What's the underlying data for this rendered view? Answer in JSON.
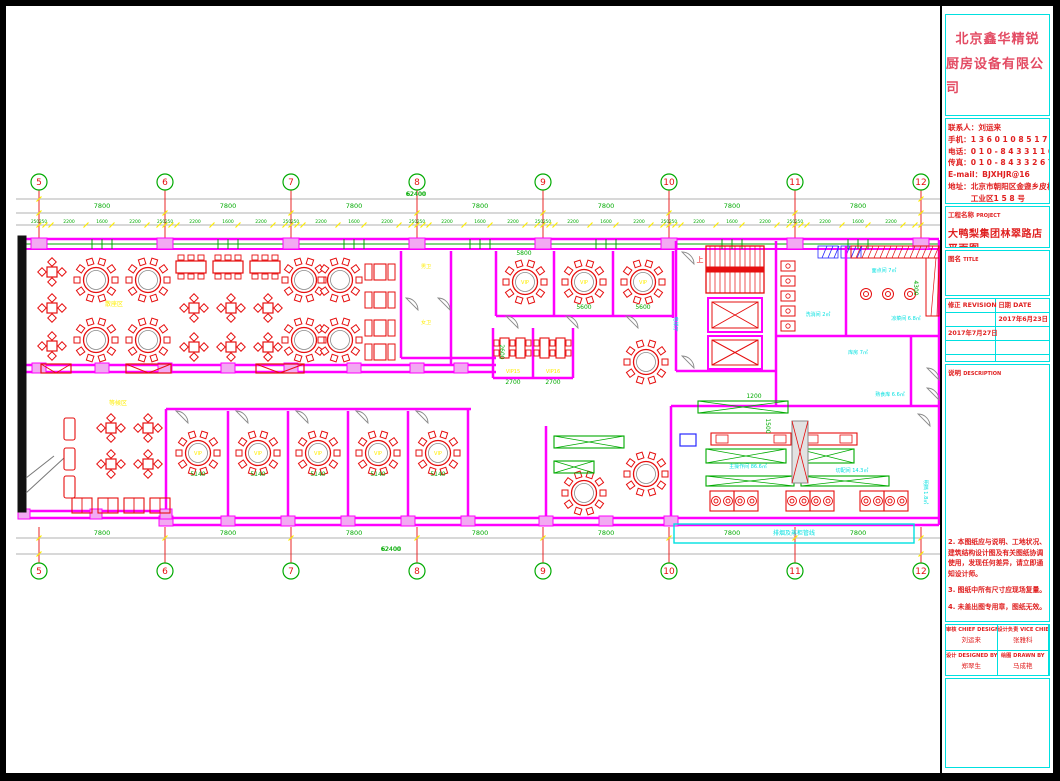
{
  "titleblock": {
    "company_line1": "北京鑫华精锐",
    "company_line2": "厨房设备有限公司",
    "contact": {
      "lines": [
        "联系人：刘运来",
        "手机：1 3 6 0 1 0 8 5 1 7 1",
        "电话：0 1 0 - 8 4 3 3 1 1 6 5",
        "传真：0 1 0 - 8 4 3 3 2 6 7 9",
        "E-mail：BJXHJR@16",
        "地址：北京市朝阳区金盏乡皮村",
        "　　　工业区1 5 8 号"
      ]
    },
    "project_label": "工程名称",
    "project_label_en": "PROJECT",
    "project_name": "大鸭梨集团林翠路店平面图",
    "title_label": "图名",
    "title_label_en": "TITLE",
    "revision_label": "修正",
    "revision_label_en": "REVISION",
    "date_label": "日期",
    "date_label_en": "DATE",
    "revisions": [
      {
        "rev": "",
        "date": "2017年6月23日"
      },
      {
        "rev": "2017年7月27日",
        "date": ""
      },
      {
        "rev": "",
        "date": ""
      },
      {
        "rev": "",
        "date": ""
      }
    ],
    "desc_label": "说明",
    "desc_label_en": "DESCRIPTION",
    "notes": [
      "2. 本图纸应与说明、工地状况、建筑结构设计图及有关图纸协调使用，发现任何差异，请立即通知设计师。",
      "3. 图纸中所有尺寸应现场复量。",
      "4. 未盖出图专用章，图纸无效。"
    ],
    "sign": {
      "chief_label": "审核",
      "chief_en": "CHIEF DESIGNER",
      "chief_name": "刘运来",
      "vice_label": "设计负责",
      "vice_en": "VICE CHIEF DESIGNER",
      "vice_name": "张雅科",
      "designed_label": "设计",
      "designed_en": "DESIGNED BY",
      "designed_name": "郑翠生",
      "drawn_label": "绘图",
      "drawn_en": "DRAWN BY",
      "drawn_name": "马成艳"
    }
  },
  "plan": {
    "colors": {
      "m": "#ff00ff",
      "r": "#e60f0f",
      "g": "#00c800",
      "y": "#ffee00",
      "c": "#00e0e0",
      "k": "#000000",
      "e": "#8a8a8a",
      "b": "#2828ff",
      "p": "#f2a9f2",
      "d": "#00aa00"
    },
    "grid": {
      "labels": [
        "5",
        "6",
        "7",
        "8",
        "9",
        "10",
        "11",
        "12"
      ],
      "xs": [
        33,
        159,
        285,
        411,
        537,
        663,
        789,
        915
      ],
      "top_bubble_y": 176,
      "bottom_bubble_y": 565,
      "bay_label": "7800",
      "total_label": "62400",
      "chain_center_label": "250250",
      "chain_labels": [
        "2200",
        "1600",
        "2200"
      ],
      "chain_offsets": [
        30,
        63,
        96
      ],
      "tick_offsets": [
        6,
        12,
        47,
        73,
        108,
        120
      ]
    },
    "gray_hlines": [
      [
        10,
        193,
        936
      ],
      [
        10,
        207,
        936
      ],
      [
        10,
        219,
        936
      ],
      [
        10,
        532,
        936
      ],
      [
        10,
        548,
        936
      ]
    ],
    "walls_h": [
      [
        18,
        359,
        490
      ],
      [
        18,
        366,
        490
      ],
      [
        490,
        310,
        667
      ],
      [
        487,
        372,
        567
      ],
      [
        670,
        365,
        770
      ],
      [
        770,
        330,
        933
      ],
      [
        665,
        400,
        933
      ],
      [
        160,
        403,
        465
      ],
      [
        395,
        352,
        490
      ],
      [
        18,
        505,
        160
      ],
      [
        18,
        512,
        160
      ],
      [
        160,
        512,
        665
      ],
      [
        160,
        519,
        665
      ],
      [
        665,
        512,
        933
      ],
      [
        665,
        519,
        933
      ]
    ],
    "walls_v": [
      [
        445,
        245,
        359
      ],
      [
        490,
        245,
        310
      ],
      [
        548,
        245,
        310
      ],
      [
        607,
        245,
        310
      ],
      [
        667,
        245,
        312
      ],
      [
        487,
        322,
        372
      ],
      [
        527,
        322,
        372
      ],
      [
        567,
        322,
        372
      ],
      [
        670,
        235,
        365
      ],
      [
        770,
        235,
        400
      ],
      [
        840,
        240,
        330
      ],
      [
        905,
        330,
        400
      ],
      [
        933,
        234,
        519
      ],
      [
        18,
        234,
        505
      ],
      [
        160,
        403,
        512
      ],
      [
        222,
        405,
        512
      ],
      [
        282,
        405,
        512
      ],
      [
        342,
        405,
        512
      ],
      [
        402,
        405,
        512
      ],
      [
        462,
        403,
        519
      ],
      [
        540,
        420,
        512
      ],
      [
        665,
        400,
        519
      ],
      [
        395,
        245,
        352
      ]
    ],
    "top_wall": {
      "y1": 233,
      "y2": 243,
      "mid": 238,
      "x1": 18,
      "x2": 933
    },
    "posts_south": [
      33,
      96,
      159,
      222,
      285,
      348,
      411,
      455
    ],
    "posts_bottom": [
      160,
      222,
      282,
      342,
      402,
      462,
      540,
      600,
      665
    ],
    "posts_bl": [
      18,
      90,
      160
    ],
    "round_tables": [
      [
        90,
        274
      ],
      [
        142,
        274
      ],
      [
        90,
        334
      ],
      [
        142,
        334
      ],
      [
        298,
        274
      ],
      [
        334,
        274
      ],
      [
        298,
        334
      ],
      [
        334,
        334
      ],
      [
        519,
        276
      ],
      [
        578,
        276
      ],
      [
        637,
        276
      ],
      [
        640,
        356
      ],
      [
        192,
        447
      ],
      [
        252,
        447
      ],
      [
        312,
        447
      ],
      [
        372,
        447
      ],
      [
        432,
        447
      ],
      [
        578,
        487
      ],
      [
        640,
        468
      ]
    ],
    "square_tables": [
      [
        46,
        266
      ],
      [
        46,
        302
      ],
      [
        46,
        340
      ],
      [
        188,
        302
      ],
      [
        225,
        302
      ],
      [
        262,
        302
      ],
      [
        188,
        341
      ],
      [
        225,
        341
      ],
      [
        262,
        341
      ],
      [
        105,
        422
      ],
      [
        142,
        422
      ],
      [
        105,
        458
      ],
      [
        142,
        458
      ]
    ],
    "rect_tables_h": [
      [
        185,
        261
      ],
      [
        222,
        261
      ],
      [
        259,
        261
      ]
    ],
    "booth_units": [
      [
        368,
        258
      ],
      [
        368,
        286
      ],
      [
        368,
        314
      ],
      [
        368,
        338
      ]
    ],
    "vip_rect_tables": [
      [
        494,
        332
      ],
      [
        510,
        332
      ],
      [
        534,
        332
      ],
      [
        550,
        332
      ]
    ],
    "sofas": [
      [
        58,
        412
      ],
      [
        58,
        442
      ],
      [
        58,
        470
      ]
    ],
    "bottom_booths": [
      [
        66,
        492
      ],
      [
        92,
        492
      ],
      [
        118,
        492
      ],
      [
        144,
        492
      ]
    ],
    "stairs": [
      700,
      240,
      58,
      47
    ],
    "elevators": [
      [
        702,
        292,
        54,
        34
      ],
      [
        702,
        330,
        54,
        33
      ]
    ],
    "hatch_red": [
      [
        845,
        240,
        88,
        12
      ],
      [
        920,
        252,
        13,
        58
      ]
    ],
    "range_circles": [
      [
        860,
        288
      ],
      [
        882,
        288
      ],
      [
        904,
        288
      ]
    ],
    "small_boxes": [
      [
        775,
        255
      ],
      [
        775,
        270
      ],
      [
        775,
        285
      ],
      [
        775,
        300
      ],
      [
        775,
        315
      ]
    ],
    "green_tables": [
      [
        700,
        443,
        80,
        14
      ],
      [
        792,
        443,
        56,
        14
      ],
      [
        700,
        470,
        88,
        10
      ],
      [
        795,
        470,
        88,
        10
      ],
      [
        692,
        395,
        90,
        12
      ],
      [
        548,
        430,
        70,
        12
      ],
      [
        548,
        455,
        40,
        12
      ]
    ],
    "red_tables": [
      [
        705,
        427,
        80,
        12
      ],
      [
        795,
        427,
        56,
        12
      ]
    ],
    "wok_boxes": [
      [
        704,
        485
      ],
      [
        728,
        485
      ],
      [
        780,
        485
      ],
      [
        804,
        485
      ],
      [
        854,
        485
      ],
      [
        878,
        485
      ]
    ],
    "duct": [
      786,
      415,
      16,
      62
    ],
    "blue_box": [
      674,
      428,
      16,
      12
    ],
    "blue_hatch": [
      [
        812,
        240,
        20,
        12
      ],
      [
        835,
        240,
        20,
        12
      ]
    ],
    "window_x_boxes": [
      [
        35,
        358,
        30
      ],
      [
        120,
        358,
        45
      ],
      [
        250,
        358,
        48
      ]
    ],
    "cyan_box": [
      668,
      518,
      240,
      19
    ],
    "black_bar": [
      12,
      230,
      8,
      276
    ],
    "wedge_lines": [
      [
        20,
        487,
        58,
        452
      ],
      [
        20,
        472,
        48,
        450
      ]
    ],
    "doors": [
      [
        170,
        405
      ],
      [
        230,
        405
      ],
      [
        290,
        405
      ],
      [
        350,
        405
      ],
      [
        410,
        405
      ],
      [
        500,
        310
      ],
      [
        560,
        310
      ],
      [
        620,
        310
      ],
      [
        676,
        246
      ],
      [
        676,
        350
      ],
      [
        400,
        292
      ],
      [
        432,
        292
      ],
      [
        912,
        408
      ],
      [
        921,
        362
      ],
      [
        921,
        382
      ]
    ],
    "dims_green": [
      [
        410,
        190,
        "62400",
        0
      ],
      [
        385,
        545,
        "62400",
        0
      ],
      [
        518,
        249,
        "5800",
        0
      ],
      [
        578,
        303,
        "5600",
        0
      ],
      [
        637,
        303,
        "5600",
        0
      ],
      [
        507,
        378,
        "2700",
        0
      ],
      [
        547,
        378,
        "2700",
        0
      ],
      [
        192,
        470,
        "5140",
        0
      ],
      [
        252,
        470,
        "5140",
        0
      ],
      [
        312,
        470,
        "5140",
        0
      ],
      [
        372,
        470,
        "5140",
        0
      ],
      [
        432,
        470,
        "5140",
        0
      ],
      [
        908,
        282,
        "4300",
        90
      ],
      [
        494,
        346,
        "2600",
        90
      ],
      [
        760,
        420,
        "1500",
        90
      ],
      [
        748,
        392,
        "1200",
        0
      ]
    ],
    "labels": [
      [
        108,
        300,
        "散座区",
        "y",
        6,
        0
      ],
      [
        112,
        399,
        "等候区",
        "y",
        6,
        0
      ],
      [
        519,
        278,
        "VIP",
        "y",
        5,
        0
      ],
      [
        578,
        278,
        "VIP",
        "y",
        5,
        0
      ],
      [
        637,
        278,
        "VIP",
        "y",
        5,
        0
      ],
      [
        192,
        449,
        "VIP",
        "y",
        5,
        0
      ],
      [
        252,
        449,
        "VIP",
        "y",
        5,
        0
      ],
      [
        312,
        449,
        "VIP",
        "y",
        5,
        0
      ],
      [
        372,
        449,
        "VIP",
        "y",
        5,
        0
      ],
      [
        432,
        449,
        "VIP",
        "y",
        5,
        0
      ],
      [
        507,
        367,
        "VIP15",
        "y",
        5,
        0
      ],
      [
        547,
        367,
        "VIP16",
        "y",
        5,
        0
      ],
      [
        420,
        262,
        "男卫",
        "y",
        5,
        0
      ],
      [
        420,
        318,
        "女卫",
        "y",
        5,
        0
      ],
      [
        694,
        256,
        "上",
        "r",
        7,
        0
      ],
      [
        812,
        310,
        "洗消间 2㎡",
        "c",
        5,
        0
      ],
      [
        878,
        266,
        "面点间 7㎡",
        "c",
        5,
        0
      ],
      [
        900,
        314,
        "凉菜间 6.8㎡",
        "c",
        5,
        0
      ],
      [
        852,
        348,
        "库房 7㎡",
        "c",
        5,
        0
      ],
      [
        742,
        462,
        "主操作间 86.6㎡",
        "c",
        5,
        0
      ],
      [
        846,
        466,
        "切配间 14.3㎡",
        "c",
        5,
        0
      ],
      [
        884,
        390,
        "熟食库 6.6㎡",
        "c",
        5,
        0
      ],
      [
        918,
        486,
        "明档 1.8㎡",
        "c",
        5,
        90
      ],
      [
        788,
        529,
        "排烟及蒸柜管线",
        "c",
        6,
        0
      ],
      [
        668,
        318,
        "电梯厅",
        "c",
        5,
        90
      ]
    ]
  }
}
